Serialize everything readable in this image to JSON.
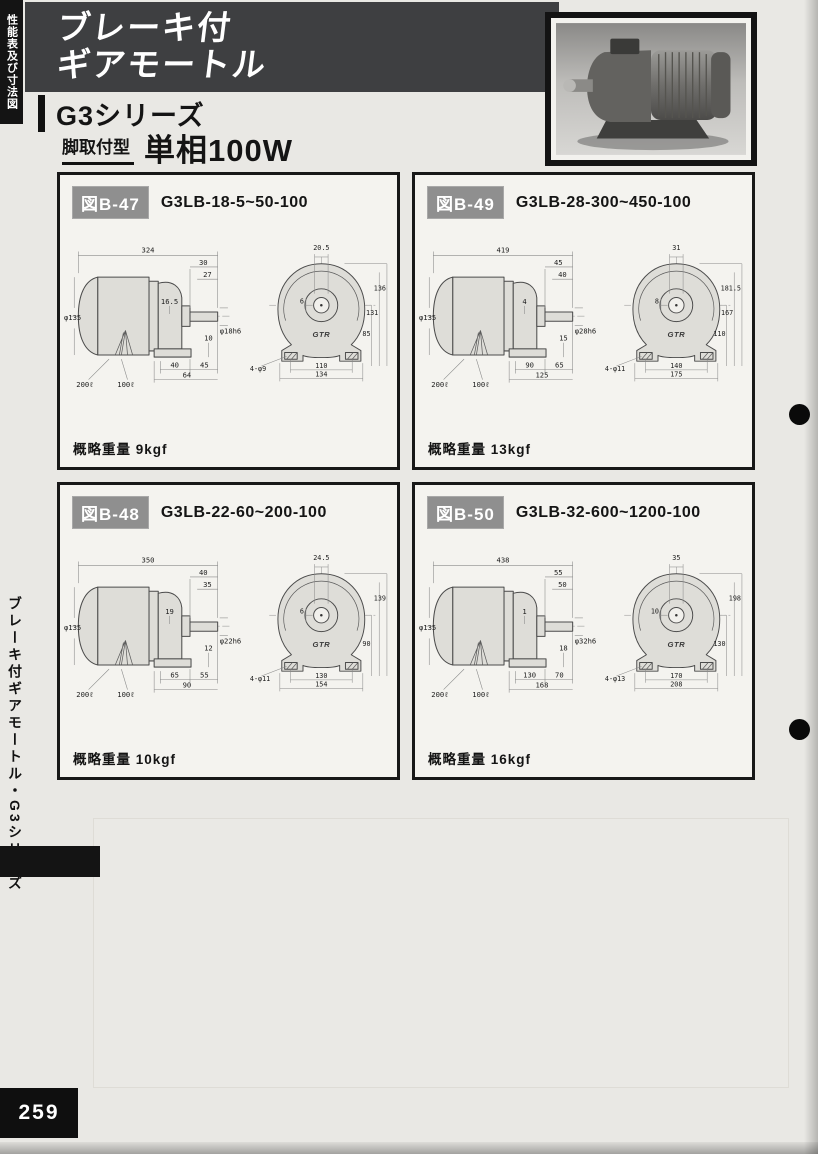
{
  "page": {
    "corner_tab": "性能表及び寸法図",
    "title_line1": "ブレーキ付",
    "title_line2": "ギアモートル",
    "series": "G3シリーズ",
    "mount_type": "脚取付型",
    "power": "単相100W",
    "side_tab": "ブレーキ付ギアモートル・G3シリーズ",
    "page_number": "259",
    "logo": "GTR"
  },
  "figures": [
    {
      "fig_label": "図B-47",
      "model": "G3LB-18-5~50-100",
      "weight_label": "概略重量",
      "weight": "9kgf",
      "side": {
        "overall": "324",
        "top1": "30",
        "top2": "27",
        "offset": "16.5",
        "dia": "φ135",
        "shaft": "φ18h6",
        "foot": "10",
        "cable1": "200ℓ",
        "cable2": "100ℓ",
        "b1": "40",
        "b2": "45",
        "b3": "64"
      },
      "front": {
        "key_w": "20.5",
        "key": "6",
        "h1": "136",
        "h2": "131",
        "h3": "85",
        "holes": "4-φ9",
        "w1": "110",
        "w2": "134"
      }
    },
    {
      "fig_label": "図B-49",
      "model": "G3LB-28-300~450-100",
      "weight_label": "概略重量",
      "weight": "13kgf",
      "side": {
        "overall": "419",
        "top1": "45",
        "top2": "40",
        "offset": "4",
        "dia": "φ135",
        "shaft": "φ28h6",
        "foot": "15",
        "cable1": "200ℓ",
        "cable2": "100ℓ",
        "b1": "90",
        "b2": "65",
        "b3": "125"
      },
      "front": {
        "key_w": "31",
        "key": "8",
        "h1": "181.5",
        "h2": "167",
        "h3": "110",
        "holes": "4-φ11",
        "w1": "140",
        "w2": "175"
      }
    },
    {
      "fig_label": "図B-48",
      "model": "G3LB-22-60~200-100",
      "weight_label": "概略重量",
      "weight": "10kgf",
      "side": {
        "overall": "350",
        "top1": "40",
        "top2": "35",
        "offset": "19",
        "dia": "φ135",
        "shaft": "φ22h6",
        "foot": "12",
        "cable1": "200ℓ",
        "cable2": "100ℓ",
        "b1": "65",
        "b2": "55",
        "b3": "90"
      },
      "front": {
        "key_w": "24.5",
        "key": "6",
        "h1": "139",
        "h2": "",
        "h3": "90",
        "holes": "4-φ11",
        "w1": "130",
        "w2": "154"
      }
    },
    {
      "fig_label": "図B-50",
      "model": "G3LB-32-600~1200-100",
      "weight_label": "概略重量",
      "weight": "16kgf",
      "side": {
        "overall": "438",
        "top1": "55",
        "top2": "50",
        "offset": "1",
        "dia": "φ135",
        "shaft": "φ32h6",
        "foot": "18",
        "cable1": "200ℓ",
        "cable2": "100ℓ",
        "b1": "130",
        "b2": "70",
        "b3": "168"
      },
      "front": {
        "key_w": "35",
        "key": "10",
        "h1": "198",
        "h2": "",
        "h3": "130",
        "holes": "4-φ13",
        "w1": "170",
        "w2": "208"
      }
    }
  ]
}
